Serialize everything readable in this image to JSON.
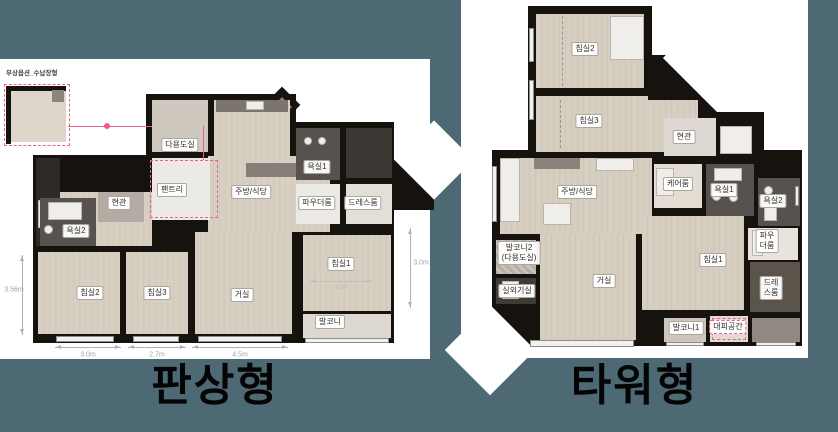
{
  "colors": {
    "background": "#4d6974",
    "wall": "#16130f",
    "floor_wood": "#d7cfc1",
    "accent_pink": "#ec5f88"
  },
  "left_plan": {
    "title": "판상형",
    "inset_caption": "무상옵션_수납장형",
    "room_labels": [
      {
        "name": "label-utility-room",
        "text": "다용도실",
        "x": 180,
        "y": 86
      },
      {
        "name": "label-pantry",
        "text": "팬트리",
        "x": 172,
        "y": 131
      },
      {
        "name": "label-kitchen-dining",
        "text": "주방/식당",
        "x": 251,
        "y": 133
      },
      {
        "name": "label-bath1",
        "text": "욕실1",
        "x": 317,
        "y": 108
      },
      {
        "name": "label-powder-room",
        "text": "파우더룸",
        "x": 317,
        "y": 144
      },
      {
        "name": "label-dress-room",
        "text": "드레스룸",
        "x": 363,
        "y": 144
      },
      {
        "name": "label-entrance",
        "text": "현관",
        "x": 119,
        "y": 144
      },
      {
        "name": "label-bath2",
        "text": "욕실2",
        "x": 76,
        "y": 172
      },
      {
        "name": "label-bedroom2",
        "text": "침실2",
        "x": 90,
        "y": 234
      },
      {
        "name": "label-bedroom3",
        "text": "침실3",
        "x": 157,
        "y": 234
      },
      {
        "name": "label-living-room",
        "text": "거실",
        "x": 242,
        "y": 236
      },
      {
        "name": "label-bedroom1",
        "text": "침실1",
        "x": 341,
        "y": 205
      },
      {
        "name": "label-balcony",
        "text": "발코니",
        "x": 330,
        "y": 263
      }
    ],
    "dim_labels": [
      {
        "name": "dim-bedroom2-width",
        "text": "3.0m",
        "x": 88,
        "y": 296
      },
      {
        "name": "dim-bedroom3-width",
        "text": "2.7m",
        "x": 157,
        "y": 296
      },
      {
        "name": "dim-living-width",
        "text": "4.5m",
        "x": 240,
        "y": 296
      },
      {
        "name": "dim-right-height",
        "text": "3.0m",
        "x": 421,
        "y": 204
      },
      {
        "name": "dim-left-height",
        "text": "3.56m",
        "x": 14,
        "y": 231
      },
      {
        "name": "dim-bedroom1-width",
        "text": "3.3m",
        "x": 341,
        "y": 229,
        "variant": "faint"
      }
    ]
  },
  "right_plan": {
    "title": "타워형",
    "room_labels": [
      {
        "name": "label-bedroom2",
        "text": "침실2",
        "x": 124,
        "y": 49
      },
      {
        "name": "label-bedroom3",
        "text": "침실3",
        "x": 128,
        "y": 121
      },
      {
        "name": "label-entrance",
        "text": "현관",
        "x": 223,
        "y": 137
      },
      {
        "name": "label-kitchen-dining",
        "text": "주방/식당",
        "x": 116,
        "y": 192
      },
      {
        "name": "label-care-room",
        "text": "케어룸",
        "x": 217,
        "y": 184
      },
      {
        "name": "label-bath1",
        "text": "욕실1",
        "x": 263,
        "y": 190
      },
      {
        "name": "label-bath2",
        "text": "욕실2",
        "x": 312,
        "y": 201
      },
      {
        "name": "label-powder-room",
        "text": "파우\n더룸",
        "x": 306,
        "y": 241
      },
      {
        "name": "label-dress-room",
        "text": "드레\n스룸",
        "x": 310,
        "y": 288
      },
      {
        "name": "label-bedroom1",
        "text": "침실1",
        "x": 252,
        "y": 260
      },
      {
        "name": "label-living-room",
        "text": "거실",
        "x": 143,
        "y": 281
      },
      {
        "name": "label-balcony2-utility",
        "text": "발코니2\n(다용도실)",
        "x": 58,
        "y": 253
      },
      {
        "name": "label-outdoor-unit-room",
        "text": "실외기실",
        "x": 56,
        "y": 291
      },
      {
        "name": "label-balcony1",
        "text": "발코니1",
        "x": 225,
        "y": 328
      },
      {
        "name": "label-evacuation-space",
        "text": "대피공간",
        "x": 267,
        "y": 327,
        "variant": "pink"
      }
    ]
  }
}
